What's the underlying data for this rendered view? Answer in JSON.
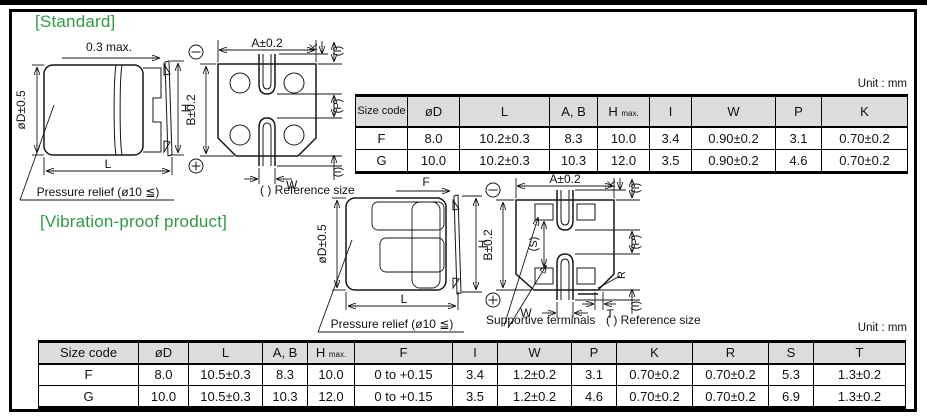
{
  "unit_label": "Unit : mm",
  "icons": {
    "negative_polarity": "⊖",
    "positive_polarity": "+"
  },
  "colors": {
    "accent_green": "#2e9b41",
    "table_header_bg": "#dcdcdc",
    "line": "#161616"
  },
  "standard": {
    "title": "[Standard]",
    "side_view": {
      "top_dim": "0.3 max.",
      "diameter_dim": "øD±0.5",
      "height_dim": "H",
      "length_dim": "L",
      "pressure_relief_label": "Pressure relief (ø10 ≦)"
    },
    "bottom_view": {
      "a_dim": "A±0.2",
      "b_dim": "B±0.2",
      "k_dim": "K",
      "i_top_dim": "(I)",
      "p_dim": "(P)",
      "w_dim": "W",
      "i_bottom_dim": "(I)",
      "reference_note": "( ) Reference size"
    },
    "table": {
      "headers": [
        "Size code",
        "øD",
        "L",
        "A, B",
        "H",
        "I",
        "W",
        "P",
        "K"
      ],
      "hmax_subscript": "max.",
      "rows": [
        [
          "F",
          "8.0",
          "10.2±0.3",
          "8.3",
          "10.0",
          "3.4",
          "0.90±0.2",
          "3.1",
          "0.70±0.2"
        ],
        [
          "G",
          "10.0",
          "10.2±0.3",
          "10.3",
          "12.0",
          "3.5",
          "0.90±0.2",
          "4.6",
          "0.70±0.2"
        ]
      ]
    }
  },
  "vibration": {
    "title": "[Vibration-proof product]",
    "side_view": {
      "top_dim": "F",
      "diameter_dim": "øD±0.5",
      "height_dim": "H",
      "length_dim": "L",
      "pressure_relief_label": "Pressure relief (ø10 ≦)"
    },
    "bottom_view": {
      "a_dim": "A±0.2",
      "b_dim": "B±0.2",
      "k_dim": "K",
      "i_top_dim": "(I)",
      "s_dim": "(S)",
      "p_dim": "(P)",
      "r_dim": "R",
      "w_dim": "W",
      "t_dim": "T",
      "i_bottom_dim": "(I)",
      "supportive_terminals_label": "Supportive terminals",
      "reference_note": "( ) Reference size"
    },
    "table": {
      "headers": [
        "Size code",
        "øD",
        "L",
        "A, B",
        "H",
        "F",
        "I",
        "W",
        "P",
        "K",
        "R",
        "S",
        "T"
      ],
      "hmax_subscript": "max.",
      "rows": [
        [
          "F",
          "8.0",
          "10.5±0.3",
          "8.3",
          "10.0",
          "0 to +0.15",
          "3.4",
          "1.2±0.2",
          "3.1",
          "0.70±0.2",
          "0.70±0.2",
          "5.3",
          "1.3±0.2"
        ],
        [
          "G",
          "10.0",
          "10.5±0.3",
          "10.3",
          "12.0",
          "0 to +0.15",
          "3.5",
          "1.2±0.2",
          "4.6",
          "0.70±0.2",
          "0.70±0.2",
          "6.9",
          "1.3±0.2"
        ]
      ]
    }
  }
}
